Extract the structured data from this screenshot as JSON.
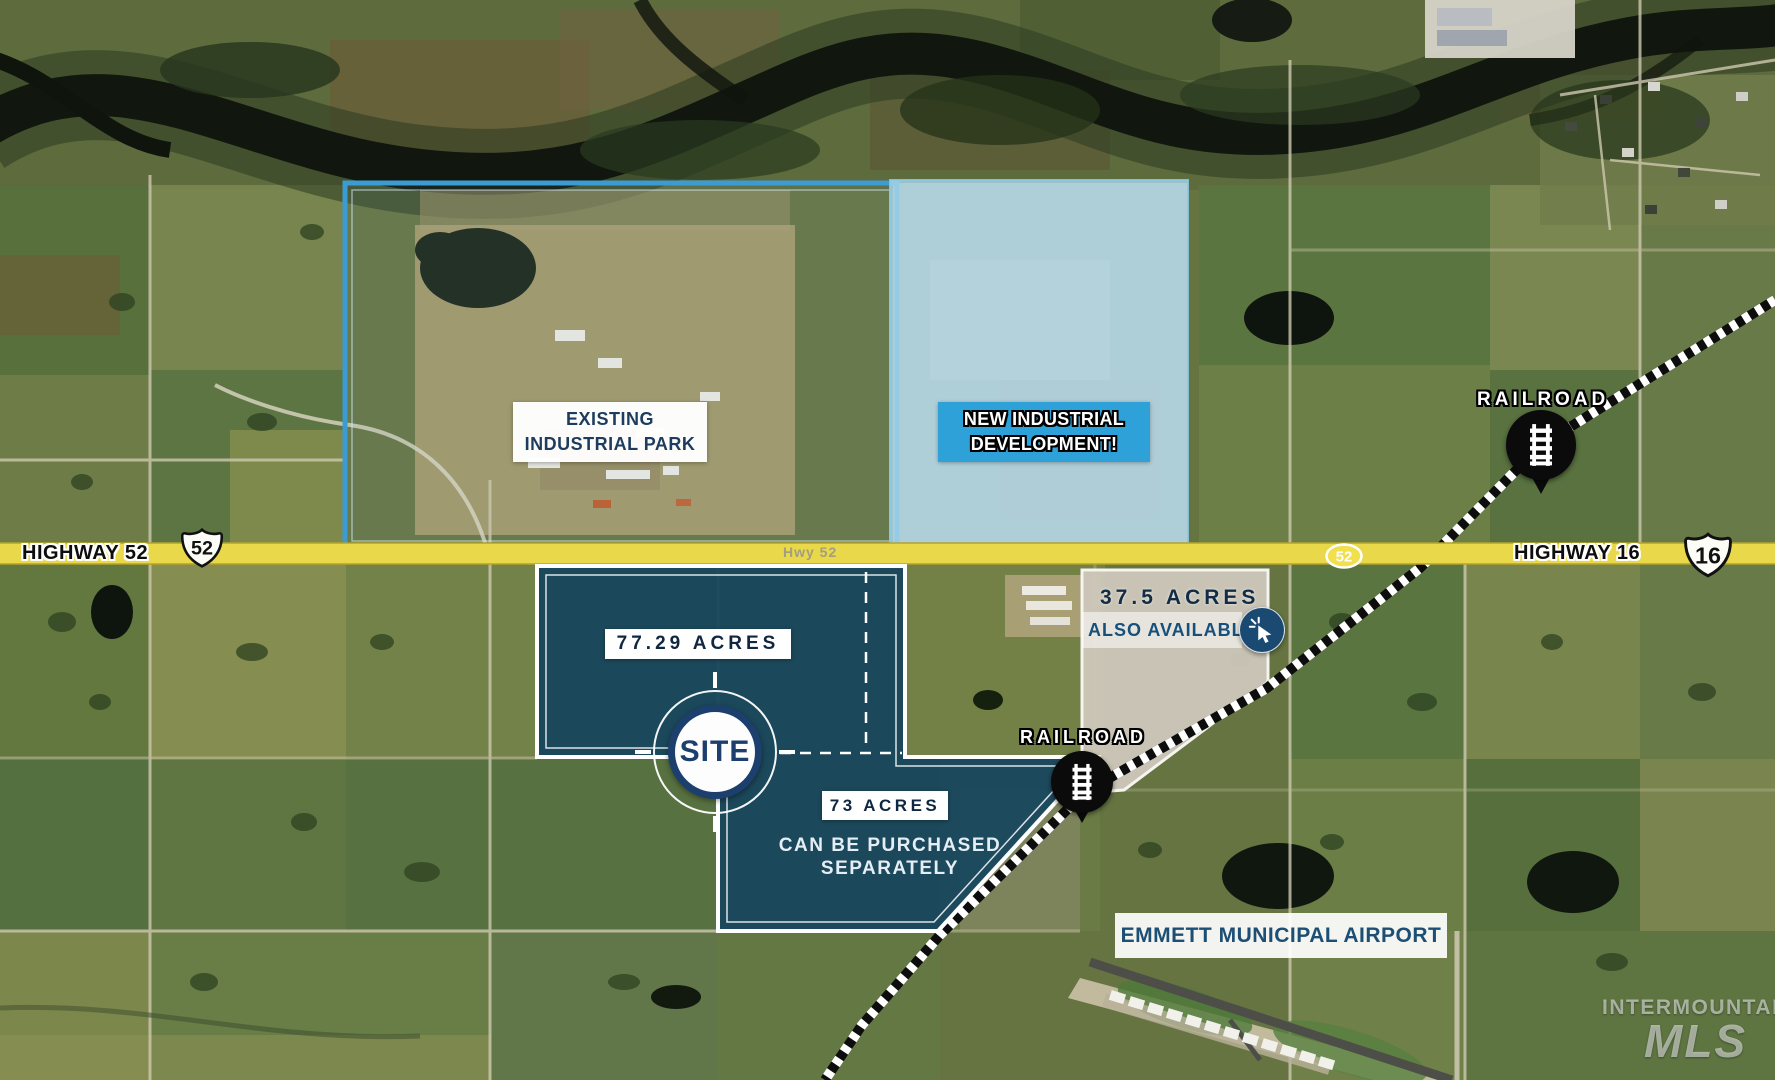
{
  "colors": {
    "parcel_navy": "#174863",
    "overlay_light_blue": "#b0d9e9",
    "park_outline_blue": "#3d9bd4",
    "label_box_blue": "#2da1d8",
    "highway_yellow": "#e8d84a",
    "navy_text": "#1d3c5e",
    "pin_black": "#0b0b0b",
    "white": "#ffffff"
  },
  "highways": {
    "h52": {
      "name": "HIGHWAY 52",
      "shield": "52",
      "road_label": "Hwy 52",
      "marker": "52"
    },
    "h16": {
      "name": "HIGHWAY 16",
      "shield": "16"
    }
  },
  "railroad": {
    "north_label": "RAILROAD",
    "south_label": "RAILROAD"
  },
  "areas": {
    "existing_park": {
      "line1": "EXISTING",
      "line2": "INDUSTRIAL PARK"
    },
    "new_development": {
      "line1": "NEW INDUSTRIAL",
      "line2": "DEVELOPMENT!"
    },
    "airport": {
      "name": "EMMETT MUNICIPAL AIRPORT"
    }
  },
  "parcels": {
    "main": {
      "acres": "77.29 ACRES",
      "badge": "SITE"
    },
    "south": {
      "acres": "73 ACRES",
      "note_line1": "CAN BE PURCHASED",
      "note_line2": "SEPARATELY"
    },
    "east": {
      "acres": "37.5 ACRES",
      "note": "ALSO AVAILABLE"
    }
  },
  "watermark": {
    "line1": "INTERMOUNTAIN",
    "line2": "MLS"
  }
}
